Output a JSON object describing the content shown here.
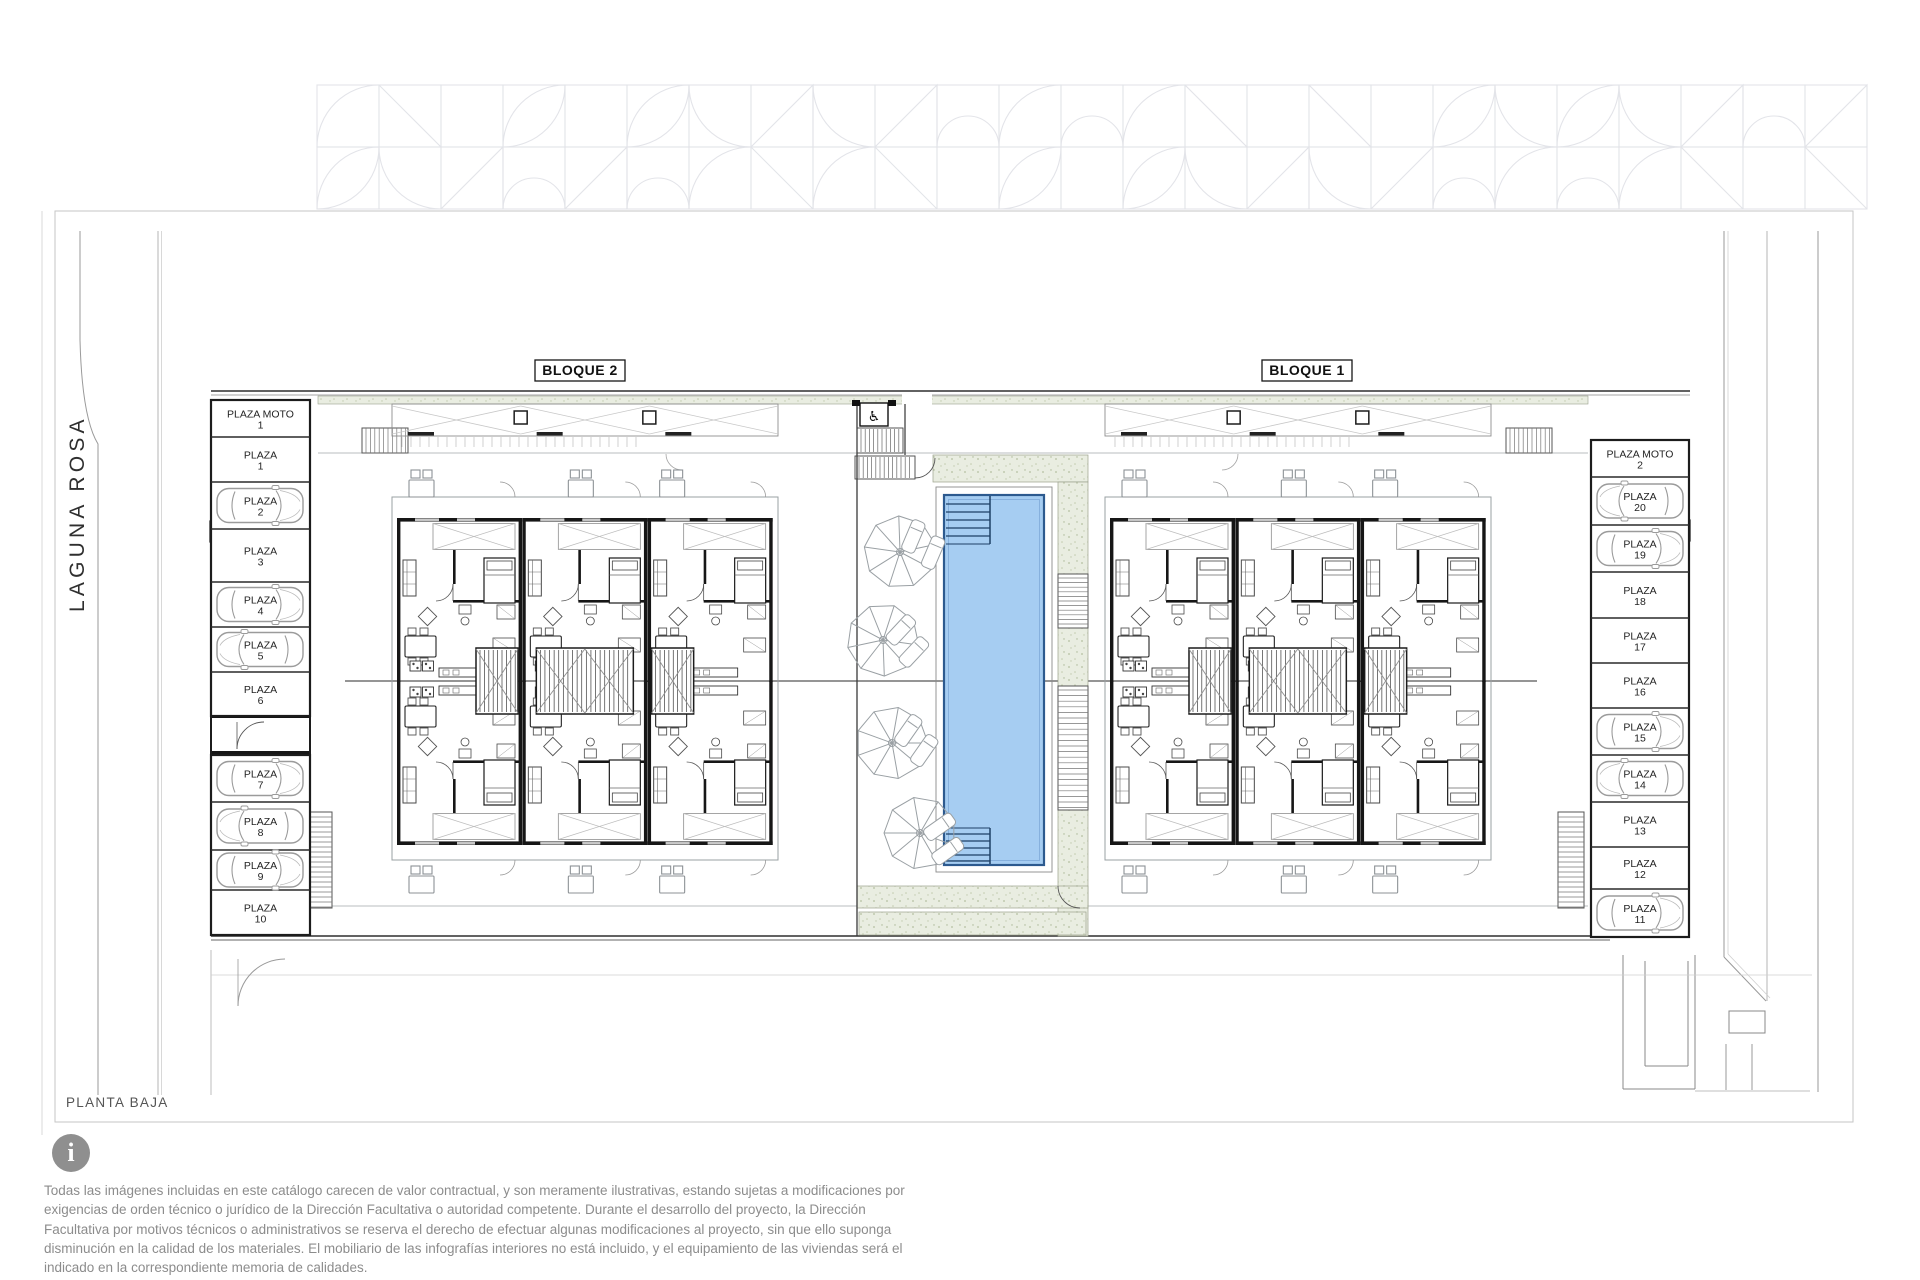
{
  "sheet": {
    "title": "PLANTA BAJA"
  },
  "street": {
    "name": "LAGUNA ROSA"
  },
  "blocks": {
    "block2_label": "BLOQUE 2",
    "block1_label": "BLOQUE 1"
  },
  "parking": {
    "left_column": [
      {
        "label": "PLAZA MOTO",
        "number": "1",
        "occupied_by_car": false
      },
      {
        "label": "PLAZA",
        "number": "1",
        "occupied_by_car": false
      },
      {
        "label": "PLAZA",
        "number": "2",
        "occupied_by_car": true
      },
      {
        "label": "PLAZA",
        "number": "3",
        "occupied_by_car": false
      },
      {
        "label": "PLAZA",
        "number": "4",
        "occupied_by_car": true
      },
      {
        "label": "PLAZA",
        "number": "5",
        "occupied_by_car": true
      },
      {
        "label": "PLAZA",
        "number": "6",
        "occupied_by_car": false
      },
      {
        "label": "PLAZA",
        "number": "7",
        "occupied_by_car": true
      },
      {
        "label": "PLAZA",
        "number": "8",
        "occupied_by_car": true
      },
      {
        "label": "PLAZA",
        "number": "9",
        "occupied_by_car": true
      },
      {
        "label": "PLAZA",
        "number": "10",
        "occupied_by_car": false
      }
    ],
    "right_column": [
      {
        "label": "PLAZA MOTO",
        "number": "2",
        "occupied_by_car": false
      },
      {
        "label": "PLAZA",
        "number": "20",
        "occupied_by_car": true
      },
      {
        "label": "PLAZA",
        "number": "19",
        "occupied_by_car": true
      },
      {
        "label": "PLAZA",
        "number": "18",
        "occupied_by_car": false
      },
      {
        "label": "PLAZA",
        "number": "17",
        "occupied_by_car": false
      },
      {
        "label": "PLAZA",
        "number": "16",
        "occupied_by_car": false
      },
      {
        "label": "PLAZA",
        "number": "15",
        "occupied_by_car": true
      },
      {
        "label": "PLAZA",
        "number": "14",
        "occupied_by_car": true
      },
      {
        "label": "PLAZA",
        "number": "13",
        "occupied_by_car": false
      },
      {
        "label": "PLAZA",
        "number": "12",
        "occupied_by_car": false
      },
      {
        "label": "PLAZA",
        "number": "11",
        "occupied_by_car": true
      }
    ]
  },
  "icons": {
    "info": "info-icon",
    "accessible_lift_glyph": "♿"
  },
  "disclaimer": {
    "icon_glyph": "i",
    "text": "Todas las imágenes incluidas en este catálogo carecen de valor contractual, y son meramente ilustrativas, estando sujetas a modificaciones por exigencias de orden técnico o jurídico de la Dirección Facultativa o autoridad competente. Durante el desarrollo del proyecto, la Dirección Facultativa por motivos técnicos o administrativos se reserva el derecho de efectuar algunas modificaciones al proyecto, sin que ello suponga disminución en la calidad de los materiales. El mobiliario de las infografías interiores no está incluido, y el equipamiento de las viviendas será el indicado en la correspondiente memoria de calidades."
  },
  "colors": {
    "pool_water": "#a6cdf2",
    "pool_edge": "#2d5a8f",
    "landscape_green": "#e9ede1",
    "wall_black": "#161616",
    "light_line": "#9aa0a3",
    "disclaimer_text": "#8c8c8c",
    "info_icon_bg": "#8f8f8f"
  }
}
